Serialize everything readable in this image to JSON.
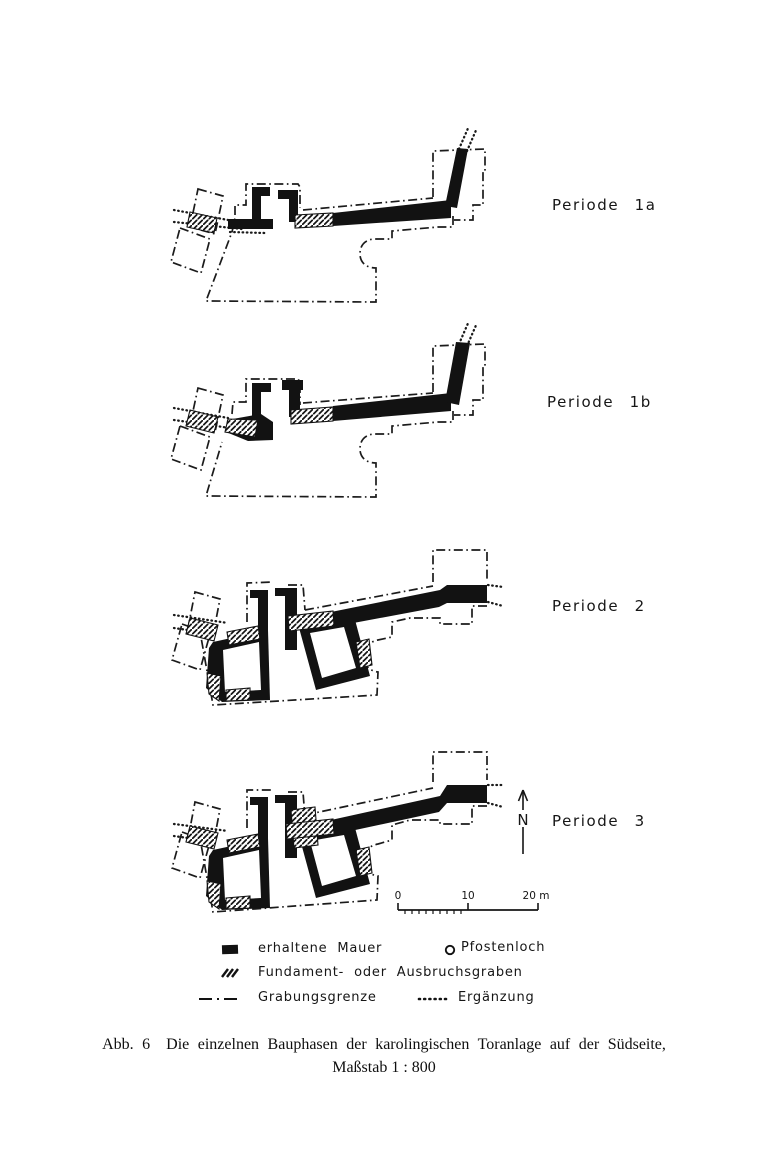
{
  "figure": {
    "ink_color": "#161616",
    "paper_color": "#ffffff",
    "periods": [
      {
        "label": "Periode 1a"
      },
      {
        "label": "Periode 1b"
      },
      {
        "label": "Periode 2"
      },
      {
        "label": "Periode 3"
      }
    ],
    "north": {
      "label": "N"
    },
    "scale": {
      "labels": [
        "0",
        "10",
        "20 m"
      ]
    },
    "legend": {
      "rows": [
        {
          "items": [
            {
              "icon": "solid-wall",
              "label": "erhaltene Mauer"
            },
            {
              "icon": "posthole-circle",
              "label": "Pfostenloch"
            }
          ]
        },
        {
          "items": [
            {
              "icon": "hatch",
              "label": "Fundament- oder Ausbruchsgraben"
            }
          ]
        },
        {
          "items": [
            {
              "icon": "dash-dot-line",
              "label": "Grabungsgrenze"
            },
            {
              "icon": "dotted-line",
              "label": "Ergänzung"
            }
          ]
        }
      ]
    },
    "caption": {
      "number": "Abb. 6",
      "line1": "Die einzelnen Bauphasen der karolingischen Toranlage auf der Südseite,",
      "line2": "Maßstab 1 : 800"
    }
  }
}
